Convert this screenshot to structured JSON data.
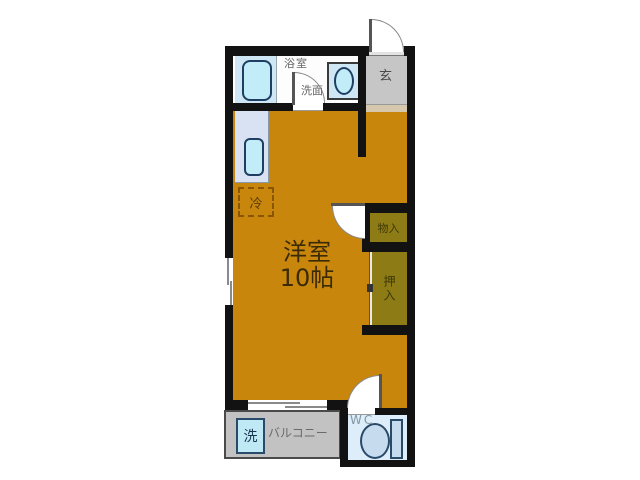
{
  "title": "floor-plan",
  "plan_type": "apartment-1R",
  "labels": {
    "main_room_name": "洋室",
    "main_room_size": "10帖",
    "bathroom": "浴室",
    "washroom": "洗面",
    "entrance": "玄",
    "storage": "物入",
    "closet": "押入",
    "wc": "WC",
    "balcony": "バルコニー",
    "washing_machine": "洗",
    "refrigerator": "冷"
  },
  "colors": {
    "wall": "#121212",
    "room_floor": "#c8860d",
    "closet_floor": "#8d7c15",
    "entrance_floor": "#c6c6c6",
    "entrance_step": "#d5c8ad",
    "fixture_panel": "#cfe6f4",
    "fixture_fill": "#c2ecf7",
    "fixture_border": "#1e3f63",
    "kitchen_counter": "#d9e2f2",
    "balcony_floor": "#c2c2c2",
    "wc_floor": "#ddeefa",
    "toilet_fill": "#c6dbed",
    "room_text": "#3a2b06"
  }
}
